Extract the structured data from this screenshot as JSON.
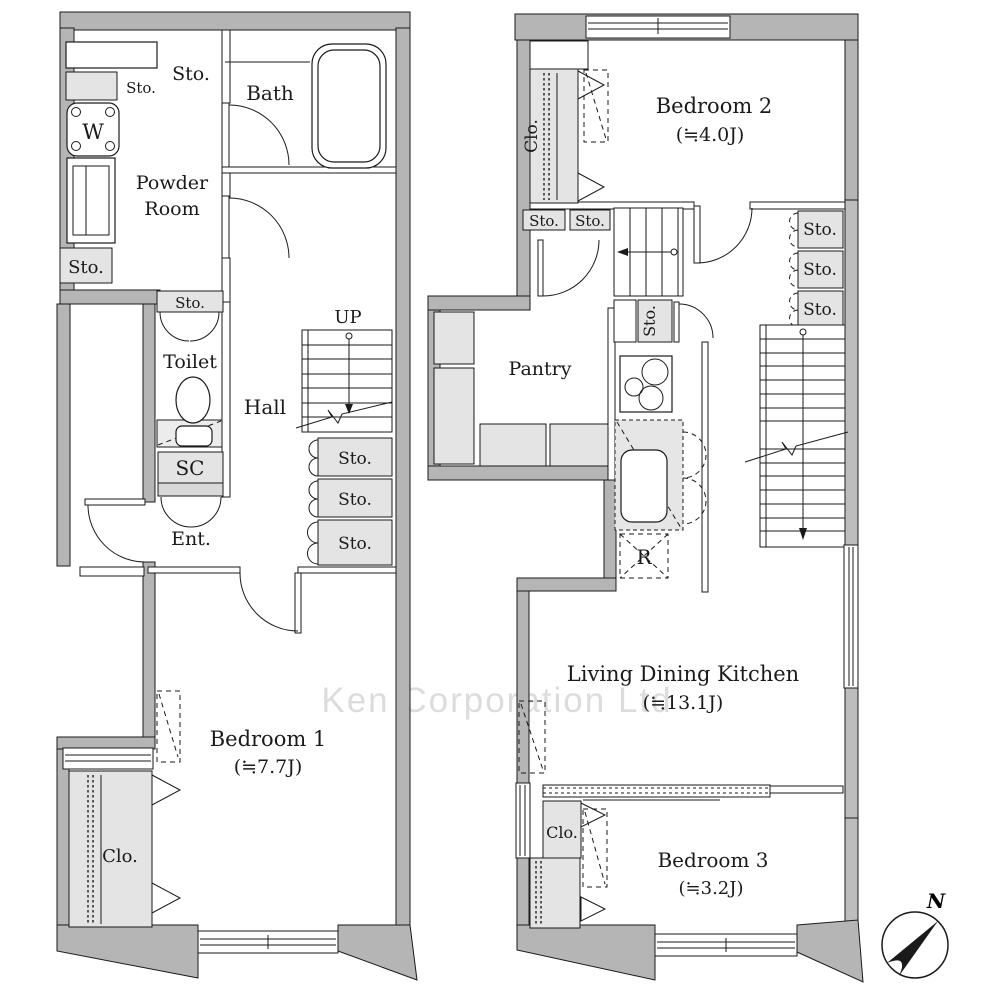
{
  "watermark": "Ken Corporation Ltd",
  "compass": {
    "north": "N"
  },
  "labels": {
    "sto": "Sto.",
    "clo": "Clo.",
    "sc": "SC",
    "washer": "W",
    "fridge": "R",
    "up": "UP",
    "bath": "Bath",
    "powder_line1": "Powder",
    "powder_line2": "Room",
    "toilet": "Toilet",
    "hall": "Hall",
    "entrance": "Ent.",
    "pantry": "Pantry",
    "bedroom1": "Bedroom 1",
    "bedroom1_size": "(≒7.7J)",
    "bedroom2": "Bedroom 2",
    "bedroom2_size": "(≒4.0J)",
    "bedroom3": "Bedroom 3",
    "bedroom3_size": "(≒3.2J)",
    "ldk": "Living Dining Kitchen",
    "ldk_size": "(≒13.1J)"
  },
  "colors": {
    "wall": "#b5b5b5",
    "storage_fill": "#e4e4e4",
    "line": "#1a1a1a",
    "watermark": "#dcdcdc"
  }
}
